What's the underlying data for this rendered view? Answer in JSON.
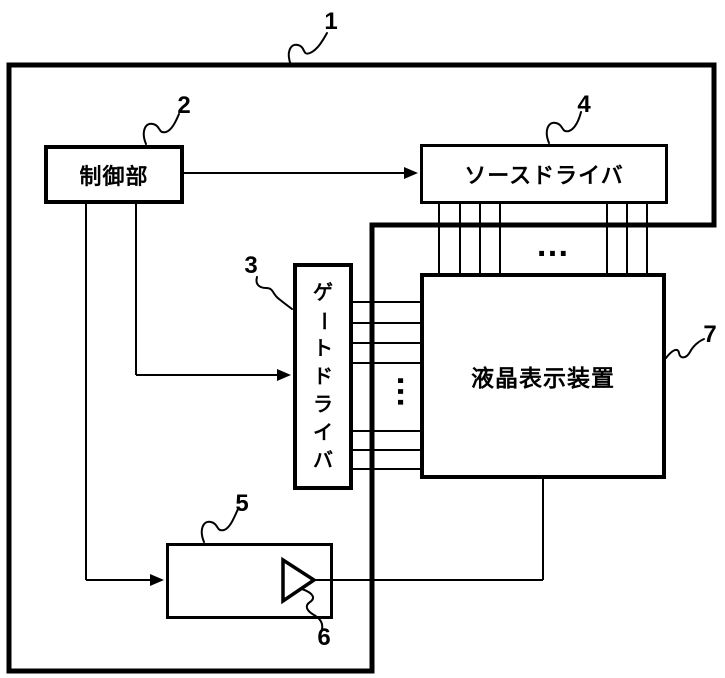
{
  "figure": {
    "colors": {
      "ink": "#000000",
      "paper": "#ffffff"
    },
    "blocks": {
      "control": "制御部",
      "source_driver": "ソースドライバ",
      "gate_driver": "ゲートドライバ",
      "display": "液晶表示装置"
    },
    "ref_labels": {
      "device": "1",
      "control": "2",
      "gate_driver": "3",
      "source_driver": "4",
      "circuit": "5",
      "amplifier": "6",
      "display": "7"
    },
    "ellipsis": {
      "horizontal": "…",
      "vertical": "…"
    }
  }
}
